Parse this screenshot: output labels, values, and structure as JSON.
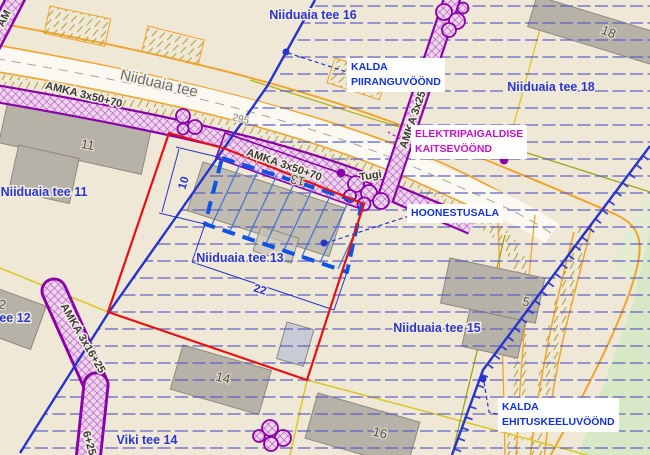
{
  "map": {
    "road": {
      "name": "Niiduaia tee",
      "parcel_number": "295"
    },
    "parcels": {
      "tee16": "Niiduaia tee 16",
      "tee18": "Niiduaia tee 18",
      "tee11": "Niiduaia tee 11",
      "tee13": "Niiduaia tee 13",
      "tee15": "Niiduaia tee 15",
      "tee12_partial": "ee 12",
      "viki14": "Viki tee 14"
    },
    "buildings": {
      "b11": "11",
      "b12": "12",
      "b13": "13",
      "b14": "14",
      "b16": "16",
      "b5": "5",
      "b18": "18"
    },
    "cables": {
      "amka50_1": "AMKA 3x50+70",
      "amka50_2": "AMKA 3x50+70",
      "amka25": "AMKA 3x25+35",
      "amka16": "AMKA 3x16+25",
      "amka16_partial": "6+25",
      "corner_partial": "AM",
      "support": "Tugi"
    },
    "dimensions": {
      "depth": "10",
      "width": "22"
    },
    "annotations": {
      "piiranguvoond": {
        "line1": "KALDA",
        "line2": "PIIRANGUVÖÖND"
      },
      "kaitsevoond": {
        "line1": "ELEKTRIPAIGALDISE",
        "line2": "KAITSEVÖÖND"
      },
      "hoonestusala": {
        "line1": "HOONESTUSALA"
      },
      "ehituskeeluvoond": {
        "line1": "KALDA",
        "line2": "EHITUSKEELUVÖÖND"
      }
    },
    "colors": {
      "boundary_red": "#e81010",
      "zone_blue": "#2733cd",
      "hoonestus_blue": "#0f52e6",
      "cable_purple": "#8a00a8",
      "annotation_blue": "#1433d6",
      "annotation_magenta": "#c713c7",
      "road_orange": "#f0a42c",
      "cadastral_yellow": "#ddc829",
      "background": "#efe8d6",
      "green_area": "#d6e8c5"
    }
  }
}
